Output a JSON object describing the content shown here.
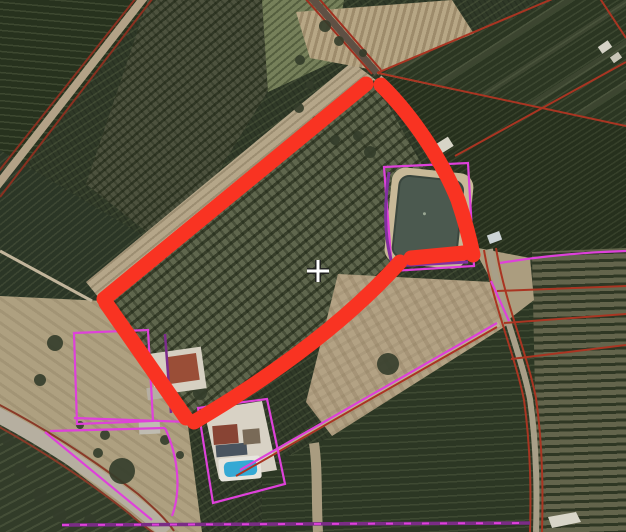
{
  "scene": {
    "type": "aerial-cadastral-map",
    "description": "Satellite view of orchard farmland with a parcel highlighted by a thick red hand-drawn outline; thin red cadastral boundaries, magenta urban parcel boundaries, a purple utility line, an irrigation pond, farmhouses with a swimming pool, rural roads and a crosshair map cursor.",
    "visible_text": ""
  },
  "canvas": {
    "width": 626,
    "height": 532
  },
  "colors": {
    "selection_red": "#f93322",
    "cadastral_red": "#a93522",
    "urban_magenta": "#de41da",
    "utility_purple": "#7b2c86",
    "pond_purple": "#8230a0",
    "water": "#4b594f",
    "sand": "#c8b998",
    "soil_tan": "#b3a284",
    "orchard_dark": "#2f3927",
    "road_gray": "#b6afa0",
    "pool_blue": "#35a9d4",
    "cursor_white": "#ffffff",
    "cursor_black": "#1c1c1c"
  },
  "selection": {
    "name": "highlighted-parcel-outline",
    "stroke_width": 15,
    "segments": [
      "M104,299 L366,84",
      "M381,85 C415,118 444,165 458,200 C464,218 470,240 473,255",
      "M464,253 L411,258",
      "M400,262 Q325,345 194,422",
      "M186,418 L106,303"
    ]
  },
  "cadastral_lines": [
    {
      "d": "M377,73 L557,-3"
    },
    {
      "d": "M378,73 L626,126"
    },
    {
      "d": "M455,156 L626,62"
    },
    {
      "d": "M599,-3 L626,38"
    },
    {
      "d": "M497,291 L626,286"
    },
    {
      "d": "M504,323 L626,314"
    },
    {
      "d": "M511,359 L626,345"
    },
    {
      "d": "M236,476 L497,327"
    }
  ],
  "urban_lines": [
    {
      "d": "M384,167 L468,163 L474,266 L392,271 Z"
    },
    {
      "d": "M500,263 Q560,253 626,251"
    },
    {
      "d": "M240,470 L497,323"
    },
    {
      "d": "M491,281 L509,321"
    },
    {
      "d": "M74,333 L148,330 L153,421 L77,424 Z"
    },
    {
      "d": "M74,418 L190,422"
    },
    {
      "d": "M198,408 L267,399 L285,484 L213,503 Z"
    },
    {
      "d": "M50,431 L165,428"
    },
    {
      "d": "M165,428 C179,458 181,492 172,516"
    },
    {
      "d": "M45,432 L152,520"
    }
  ],
  "utility_lines": [
    {
      "d": "M62,525 L530,523",
      "w": 3.5,
      "c": "#7b2c86"
    },
    {
      "d": "M62,525 L530,523",
      "w": 2,
      "c": "#de41da",
      "dash": "7 11"
    },
    {
      "d": "M389,172 C384,205 384,240 393,266 L468,262",
      "w": 3,
      "c": "#8230a0"
    },
    {
      "d": "M165,334 L171,413",
      "w": 2.5,
      "c": "#7c2b8c"
    }
  ],
  "roads": [
    {
      "name": "road-topleft",
      "d": "M146,-5 L-7,191",
      "w": 8,
      "fill": "#b3a287",
      "ec": "#8a3020",
      "edges": [
        "M140,-7 L-13,186",
        "M153,-2 L0,197"
      ]
    },
    {
      "name": "track-topcenter",
      "d": "M309,-5 L377,73",
      "w": 7,
      "fill": "#5f5044",
      "ec": "#a03020",
      "edges": [
        "M304,-3 L372,74",
        "M315,-6 L381,70"
      ]
    },
    {
      "name": "road-right",
      "d": "M490,249 C499,304 521,354 530,399 C537,449 537,495 536,532",
      "w": 6,
      "fill": "#a89f88",
      "ec": "#a93522",
      "edges": [
        "M484,250 C493,305 515,355 524,400 C531,450 531,495 530,532",
        "M496,248 C505,303 527,353 536,398 C543,448 543,494 542,532"
      ]
    },
    {
      "name": "road-bottomleft",
      "d": "M-6,413 C44,439 94,472 132,502 C148,515 158,523 166,532",
      "w": 15,
      "fill": "#b6afa0",
      "ec": "#8a3a28",
      "edges": [
        "M-4,403 C48,430 98,463 138,494 C154,508 166,519 174,531",
        "M-8,423 C40,449 88,481 126,511 C140,523 148,529 154,533"
      ]
    },
    {
      "name": "track-field",
      "d": "M238,473 L499,324",
      "w": 5,
      "fill": "#bfb094",
      "ec": "",
      "edges": []
    },
    {
      "name": "track-pond",
      "d": "M380,77 C420,112 452,172 468,238",
      "w": 4,
      "fill": "#b9ac96",
      "ec": "",
      "edges": []
    },
    {
      "name": "track-left",
      "d": "M0,251 L92,301",
      "w": 3,
      "fill": "#c2b59b",
      "ec": "",
      "edges": []
    },
    {
      "name": "track-orchard-gap",
      "d": "M314,443 C318,470 316,500 318,532",
      "w": 10,
      "fill": "#a99c80",
      "ec": "",
      "edges": []
    }
  ],
  "pond": {
    "name": "irrigation-pond",
    "rotate": 6,
    "cx": 427,
    "cy": 218,
    "sand": {
      "x": 388,
      "y": 170,
      "w": 82,
      "h": 96,
      "rx": 14,
      "fill": "#c8b998"
    },
    "water": {
      "x": 396,
      "y": 178,
      "w": 64,
      "h": 82,
      "rx": 10,
      "fill": "#4b594f",
      "stroke": "#3a463e"
    },
    "dot": {
      "x": 424,
      "y": 214,
      "r": 1.5,
      "fill": "#9aa793"
    }
  },
  "buildings": [
    {
      "kind": "rect",
      "x": 152,
      "y": 350,
      "w": 52,
      "h": 42,
      "fill": "#d6d0c2",
      "rot": -8,
      "name": "farmhouse"
    },
    {
      "kind": "rect",
      "x": 168,
      "y": 355,
      "w": 30,
      "h": 27,
      "fill": "#9a4e37",
      "rot": -8,
      "name": "farmhouse-roof"
    },
    {
      "kind": "rect",
      "x": 147,
      "y": 387,
      "w": 18,
      "h": 12,
      "fill": "#b5afa2",
      "rot": -8,
      "name": "farmhouse-shed"
    },
    {
      "kind": "poly",
      "pts": "204,410 262,401 277,470 219,479",
      "fill": "#d8d2c5",
      "name": "villa-patio"
    },
    {
      "kind": "rect",
      "x": 213,
      "y": 425,
      "w": 25,
      "h": 19,
      "fill": "#884434",
      "rot": -5,
      "name": "villa-roof-red"
    },
    {
      "kind": "rect",
      "x": 216,
      "y": 444,
      "w": 31,
      "h": 12,
      "fill": "#49545f",
      "rot": -5,
      "name": "villa-roof-dark"
    },
    {
      "kind": "rect",
      "x": 243,
      "y": 429,
      "w": 17,
      "h": 15,
      "fill": "#796a57",
      "rot": -5,
      "name": "villa-roof-brown"
    },
    {
      "kind": "rect",
      "x": 219,
      "y": 457,
      "w": 42,
      "h": 23,
      "rx": 3,
      "fill": "#e7e5dd",
      "rot": -5,
      "name": "pool-deck"
    },
    {
      "kind": "rect",
      "x": 224,
      "y": 461,
      "w": 33,
      "h": 15,
      "rx": 5,
      "fill": "#35a9d4",
      "rot": -5,
      "name": "swimming-pool"
    },
    {
      "kind": "rect",
      "x": 139,
      "y": 421,
      "w": 21,
      "h": 13,
      "fill": "#bfbcb1",
      "rot": -3,
      "name": "shed"
    },
    {
      "kind": "rect",
      "x": 488,
      "y": 233,
      "w": 13,
      "h": 9,
      "fill": "#ccd3d5",
      "rot": -20,
      "name": "shed"
    },
    {
      "kind": "rect",
      "x": 436,
      "y": 140,
      "w": 16,
      "h": 11,
      "fill": "#d7d4c7",
      "rot": -32,
      "name": "shed"
    },
    {
      "kind": "rect",
      "x": 599,
      "y": 43,
      "w": 12,
      "h": 8,
      "fill": "#d4d1c5",
      "rot": -35,
      "name": "shed"
    },
    {
      "kind": "rect",
      "x": 611,
      "y": 54,
      "w": 10,
      "h": 7,
      "fill": "#c9c5b7",
      "rot": -35,
      "name": "shed"
    },
    {
      "kind": "poly",
      "pts": "548,517 576,512 581,522 552,528",
      "fill": "#d8d5c8",
      "name": "track-patch"
    }
  ],
  "trees": [
    [
      55,
      343,
      8
    ],
    [
      40,
      380,
      6
    ],
    [
      142,
      352,
      5
    ],
    [
      200,
      393,
      7
    ],
    [
      232,
      414,
      5
    ],
    [
      122,
      471,
      13
    ],
    [
      98,
      453,
      5
    ],
    [
      388,
      364,
      11
    ],
    [
      325,
      26,
      6
    ],
    [
      339,
      41,
      5
    ],
    [
      363,
      53,
      4
    ],
    [
      300,
      60,
      5
    ],
    [
      310,
      85,
      4
    ],
    [
      299,
      108,
      5
    ],
    [
      316,
      120,
      4
    ],
    [
      335,
      140,
      5
    ],
    [
      370,
      152,
      6
    ],
    [
      358,
      136,
      5
    ],
    [
      20,
      470,
      7
    ],
    [
      40,
      495,
      7
    ],
    [
      8,
      440,
      6
    ],
    [
      60,
      515,
      7
    ],
    [
      90,
      520,
      6
    ],
    [
      105,
      435,
      5
    ],
    [
      80,
      425,
      4
    ],
    [
      165,
      440,
      5
    ],
    [
      180,
      455,
      4
    ]
  ],
  "cursor": {
    "type": "crosshair",
    "x": 318,
    "y": 271,
    "arm": 11
  }
}
